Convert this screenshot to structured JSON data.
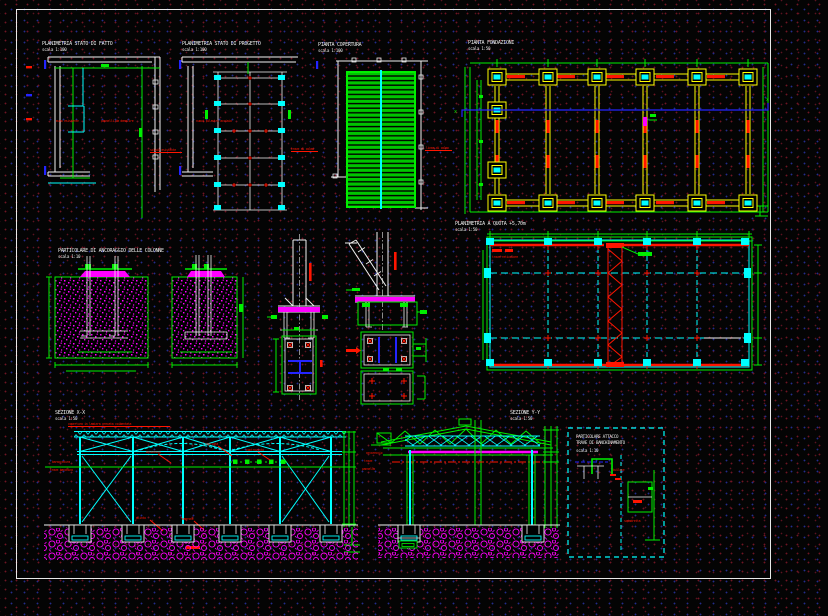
{
  "views": {
    "plan_existing": {
      "title": "PLANIMETRIA STATO DI FATTO",
      "scale": "scala 1:100"
    },
    "plan_project": {
      "title": "PLANIMETRIA STATO DI PROGETTO",
      "scale": "scala 1:100"
    },
    "roof_plan": {
      "title": "PIANTA COPERTURA",
      "scale": "scala 1:100"
    },
    "foundation_plan": {
      "title": "PIANTA FONDAZIONI",
      "scale": "scala 1:50"
    },
    "anchor_detail": {
      "title": "PARTICOLARE DI ANCORAGGIO DELLE COLONNE",
      "scale": "scala 1:10"
    },
    "level_plan": {
      "title": "PLANIMETRIA A QUOTA +5,70m",
      "scale": "scala 1:50"
    },
    "section_xx": {
      "title": "SEZIONE X-X",
      "scale": "scala 1:50"
    },
    "section_yy": {
      "title": "SEZIONE Y-Y",
      "scale": "scala 1:50"
    },
    "beam_detail": {
      "title_line1": "PARTICOLARE ATTACCO",
      "title_line2": "TRAVE DI BANCHINAMENTO",
      "scale": "scala 1:10"
    }
  },
  "markers": {
    "x": "x"
  },
  "annotations": {
    "a1": "muro esistente",
    "a2": "pannelli da demolire",
    "a3": "solaio esistente",
    "a4": "nuovi pilastri acciaio",
    "a5": "trave di colmo",
    "a6": "linea di colmo",
    "a7": "trave reticolare",
    "a9": "copertura in lamiera grecata coibentata",
    "a10": "arcarecci",
    "a11": "capriata",
    "a12": "controvento",
    "a13": "baraccatura",
    "a14": "trave banchina",
    "a15": "plinto",
    "a16": "magrone",
    "a18": "arcareccio",
    "a19": "trave",
    "a20": "pannello",
    "a21": "bullone",
    "a22": "squadretta"
  }
}
